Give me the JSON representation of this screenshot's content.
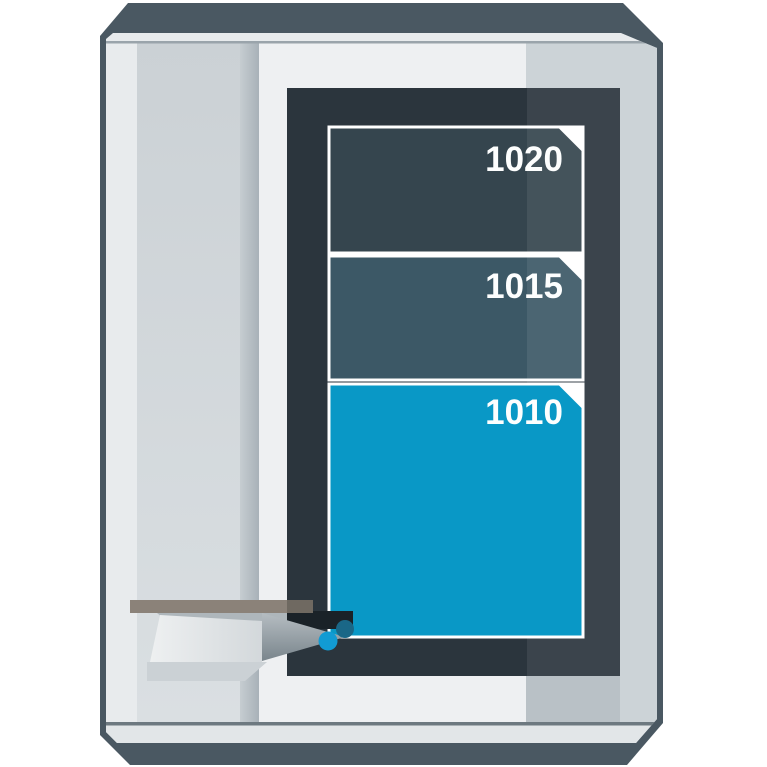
{
  "figure": {
    "type": "machine-wear-parts-illustration",
    "panels": [
      {
        "label": "1020",
        "fill": "#35454e"
      },
      {
        "label": "1015",
        "fill": "#3c5866"
      },
      {
        "label": "1010",
        "fill": "#0998c6"
      }
    ],
    "label_color": "#fdfefe",
    "window_frame_fill": "#2b353d",
    "droplets": {
      "front_fill": "#129bd3",
      "back_fill": "#1a6787"
    }
  }
}
